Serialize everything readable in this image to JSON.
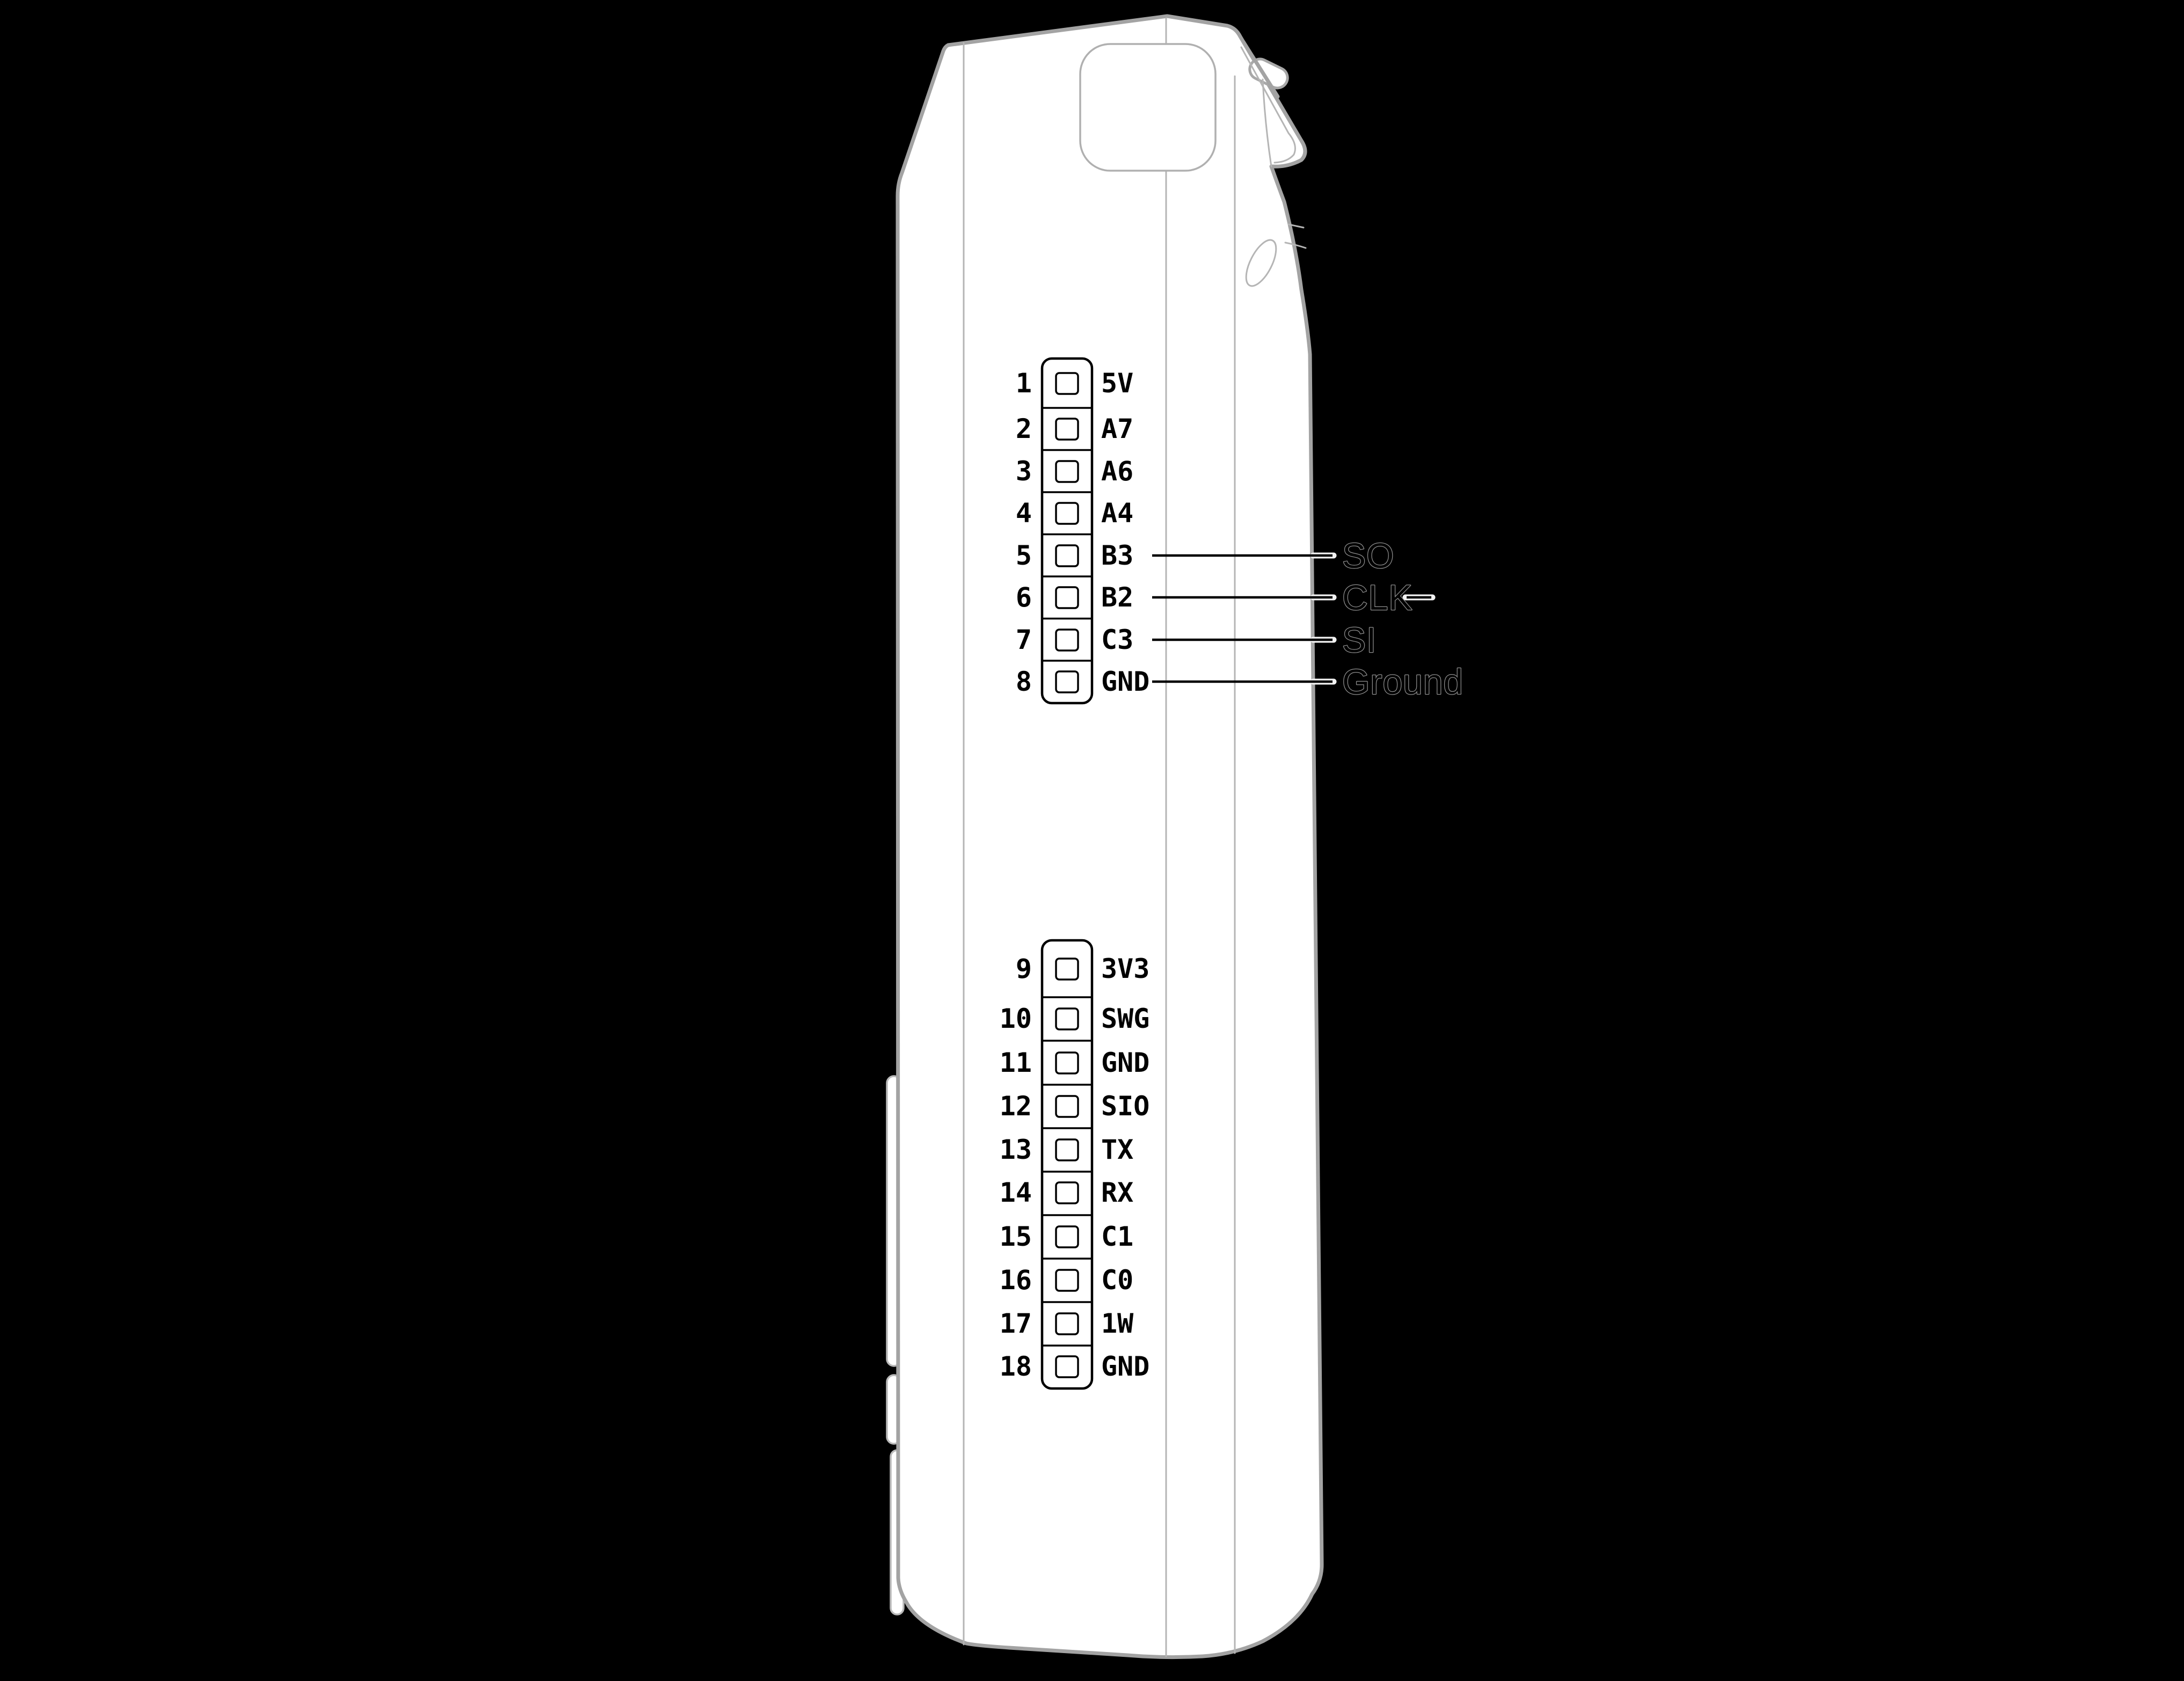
{
  "colors": {
    "background": "#000000",
    "device_fill": "#ffffff",
    "outline_gray": "#a3a3a3",
    "seam_gray": "#b5b5b5",
    "ink_black": "#000000",
    "halo_white": "#f2f2f2",
    "callout_outline_gray": "#8f8f8f"
  },
  "headers": [
    {
      "id": "top-header",
      "pins": [
        {
          "number": "1",
          "label": "5V"
        },
        {
          "number": "2",
          "label": "A7"
        },
        {
          "number": "3",
          "label": "A6"
        },
        {
          "number": "4",
          "label": "A4"
        },
        {
          "number": "5",
          "label": "B3"
        },
        {
          "number": "6",
          "label": "B2"
        },
        {
          "number": "7",
          "label": "C3"
        },
        {
          "number": "8",
          "label": "GND"
        }
      ]
    },
    {
      "id": "bottom-header",
      "pins": [
        {
          "number": "9",
          "label": "3V3"
        },
        {
          "number": "10",
          "label": "SWG"
        },
        {
          "number": "11",
          "label": "GND"
        },
        {
          "number": "12",
          "label": "SIO"
        },
        {
          "number": "13",
          "label": "TX"
        },
        {
          "number": "14",
          "label": "RX"
        },
        {
          "number": "15",
          "label": "C1"
        },
        {
          "number": "16",
          "label": "C0"
        },
        {
          "number": "17",
          "label": "1W"
        },
        {
          "number": "18",
          "label": "GND"
        }
      ]
    }
  ],
  "callouts": [
    {
      "label": "SO",
      "connects_pin_number": "5",
      "connects_pin_label": "B3"
    },
    {
      "label": "CLK",
      "connects_pin_number": "6",
      "connects_pin_label": "B2"
    },
    {
      "label": "SI",
      "connects_pin_number": "7",
      "connects_pin_label": "C3"
    },
    {
      "label": "Ground",
      "connects_pin_number": "8",
      "connects_pin_label": "GND"
    }
  ]
}
